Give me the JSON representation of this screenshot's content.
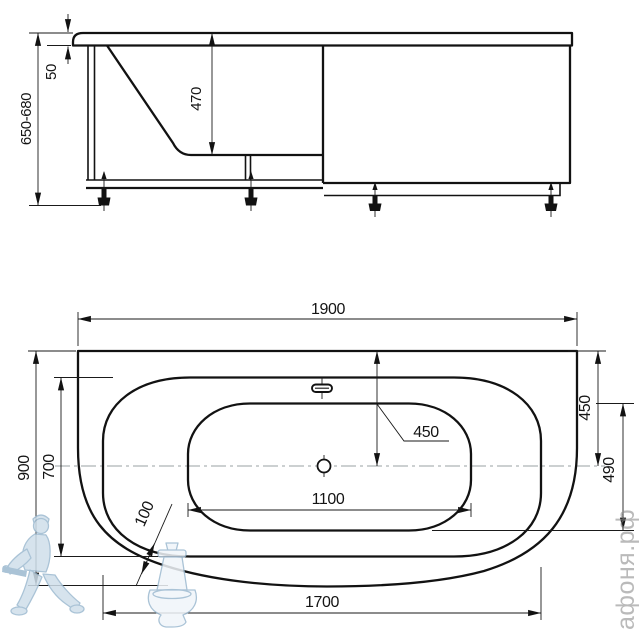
{
  "side_view": {
    "total_height": "650-680",
    "rim_height": "50",
    "bowl_depth": "470"
  },
  "plan_view": {
    "overall_length": "1900",
    "overall_width": "900",
    "body_width": "700",
    "body_length": "1700",
    "bowl_length": "1100",
    "bowl_width": "490",
    "center_from_edge": "450",
    "center_from_edge_right": "450",
    "corner_offset": "100"
  },
  "watermark": {
    "brand": "афоня.рф"
  },
  "colors": {
    "line": "#121212",
    "centerline": "#9aa0a3",
    "watermark_blue": "#cfdfeb",
    "watermark_text": "#8d8d8d",
    "background": "#ffffff"
  }
}
